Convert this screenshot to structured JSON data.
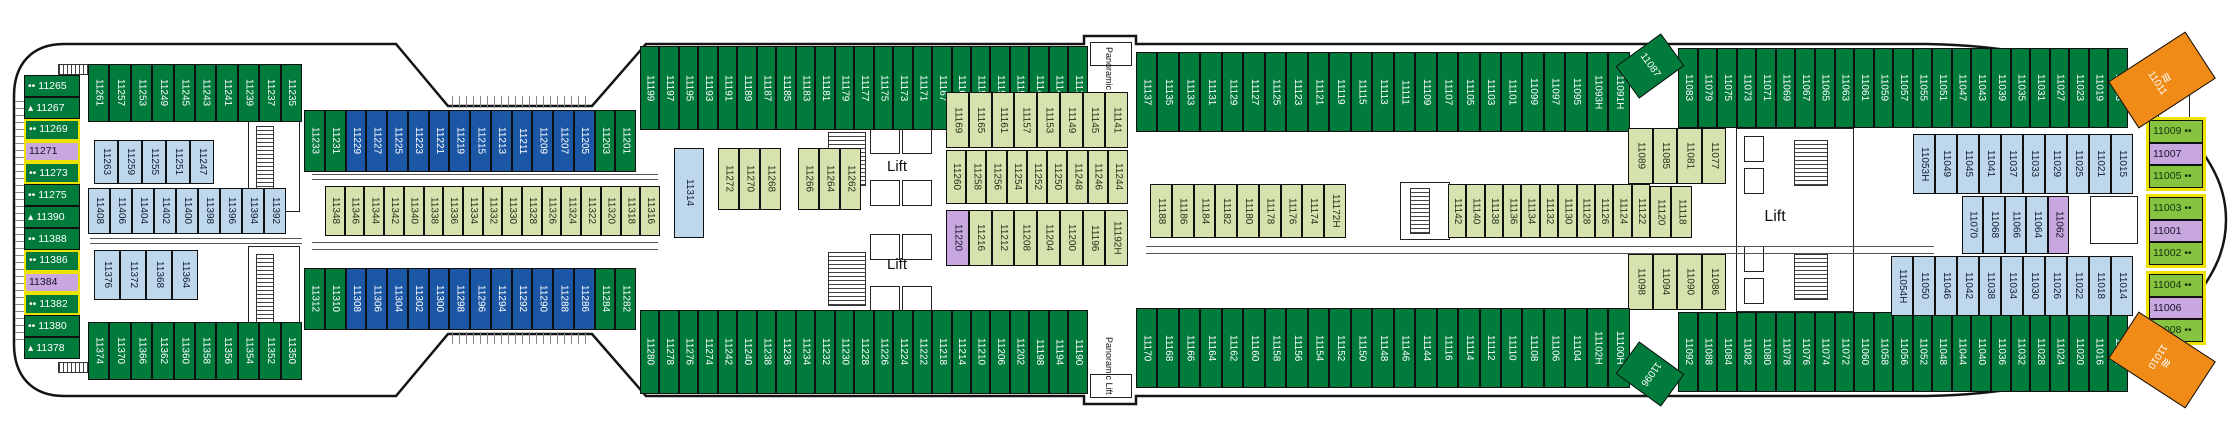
{
  "colors": {
    "green": "#007b3c",
    "blue": "#1b57a5",
    "lightblue": "#bed7eb",
    "olive": "#d6e3ae",
    "purple": "#c7a7de",
    "bowgreen": "#85c341",
    "orange": "#ef8b16"
  },
  "text_colors": {
    "green": "#ffffff",
    "blue": "#ffffff",
    "lightblue": "#0f1f33",
    "olive": "#22331a",
    "purple": "#17122b",
    "bowgreen": "#12300f",
    "orange": "#ffffff"
  },
  "deck": {
    "rows": [
      {
        "id": "stern-column",
        "t": "v",
        "x": 24,
        "y": 75,
        "w": 56,
        "h": 284,
        "c": "green",
        "cells": [
          {
            "n": "11265",
            "m": "••"
          },
          {
            "n": "11267",
            "m": "▴"
          },
          {
            "n": "11269",
            "m": "••",
            "yl": 1
          },
          {
            "n": "11271",
            "c": "purple",
            "yl": 1
          },
          {
            "n": "11273",
            "m": "••",
            "yl": 1
          },
          {
            "n": "11275",
            "m": "••"
          },
          {
            "n": "11390",
            "m": "▴"
          },
          {
            "n": "11388",
            "m": "••"
          },
          {
            "n": "11386",
            "m": "••",
            "yl": 1
          },
          {
            "n": "11384",
            "c": "purple",
            "yl": 1
          },
          {
            "n": "11382",
            "m": "••",
            "yl": 1
          },
          {
            "n": "11380",
            "m": "••"
          },
          {
            "n": "11378",
            "m": "▴"
          }
        ]
      },
      {
        "id": "stern-top-row",
        "t": "h",
        "x": 88,
        "y": 64,
        "w": 214,
        "h": 58,
        "c": "green",
        "cells": [
          "11261",
          "11257",
          "11253",
          "11249",
          "11245",
          "11243",
          "11241",
          "11239",
          "11237",
          "11235"
        ]
      },
      {
        "id": "top-inset-row",
        "t": "h",
        "x": 304,
        "y": 110,
        "w": 332,
        "h": 62,
        "c": "blue",
        "cells": [
          {
            "n": "11233",
            "c": "green"
          },
          {
            "n": "11231",
            "c": "green"
          },
          "11229",
          "11227",
          "11225",
          "11223",
          "11221",
          "11219",
          "11215",
          "11213",
          "11211",
          "11209",
          "11207",
          "11205",
          {
            "n": "11203",
            "c": "green"
          },
          {
            "n": "11201",
            "c": "green"
          }
        ]
      },
      {
        "id": "top-row-a",
        "t": "h",
        "x": 640,
        "y": 46,
        "w": 448,
        "h": 84,
        "c": "green",
        "cells": [
          "11199",
          "11197",
          "11195",
          "11193",
          "11191",
          "11189",
          "11187",
          "11185",
          "11183",
          "11181",
          "11179",
          "11177",
          "11175",
          "11173",
          "11171",
          "11167",
          "11163",
          "11159",
          "11155",
          "11151",
          "11147",
          "11143",
          "11139"
        ]
      },
      {
        "id": "top-row-b",
        "t": "h",
        "x": 1136,
        "y": 52,
        "w": 494,
        "h": 80,
        "c": "green",
        "cells": [
          "11137",
          "11135",
          "11133",
          "11131",
          "11129",
          "11127",
          "11125",
          "11123",
          "11121",
          "11119",
          "11115",
          "11113",
          "11111",
          "11109",
          "11107",
          "11105",
          "11103",
          "11101",
          "11099",
          "11097",
          "11095",
          "11093H",
          "11091H"
        ]
      },
      {
        "id": "top-row-c",
        "t": "h",
        "x": 1678,
        "y": 48,
        "w": 450,
        "h": 80,
        "c": "green",
        "cells": [
          "11083",
          "11079",
          "11075",
          "11073",
          "11071",
          "11069",
          "11067",
          "11065",
          "11063",
          "11061",
          "11059",
          "11057",
          "11055",
          "11051",
          "11047",
          "11043",
          "11039",
          "11035",
          "11031",
          "11027",
          "11023",
          "11019",
          "11013"
        ]
      },
      {
        "id": "upper-blue-row",
        "t": "h",
        "x": 94,
        "y": 140,
        "w": 120,
        "h": 44,
        "c": "lightblue",
        "cells": [
          "11263",
          "11259",
          "11255",
          "11251",
          "11247"
        ]
      },
      {
        "id": "upper-blue-row-2",
        "t": "h",
        "x": 88,
        "y": 188,
        "w": 198,
        "h": 46,
        "c": "lightblue",
        "cells": [
          "11408",
          "11406",
          "11404",
          "11402",
          "11400",
          "11398",
          "11396",
          "11394",
          "11392"
        ]
      },
      {
        "id": "mid-olive-row",
        "t": "h",
        "x": 325,
        "y": 186,
        "w": 335,
        "h": 50,
        "c": "olive",
        "cells": [
          "11348",
          "11346",
          "11344",
          "11342",
          "11340",
          "11338",
          "11336",
          "11334",
          "11332",
          "11330",
          "11328",
          "11326",
          "11324",
          "11322",
          "11320",
          "11318",
          "11316"
        ]
      },
      {
        "id": "cabin-11314-block",
        "t": "h",
        "x": 674,
        "y": 148,
        "w": 30,
        "h": 90,
        "c": "lightblue",
        "cells": [
          "11314"
        ]
      },
      {
        "id": "mid-olive-a",
        "t": "h",
        "x": 718,
        "y": 148,
        "w": 63,
        "h": 62,
        "c": "olive",
        "cells": [
          "11272",
          "11270",
          "11268"
        ]
      },
      {
        "id": "mid-olive-b",
        "t": "h",
        "x": 798,
        "y": 148,
        "w": 63,
        "h": 62,
        "c": "olive",
        "cells": [
          "11266",
          "11264",
          "11262"
        ]
      },
      {
        "id": "right-olive-1",
        "t": "h",
        "x": 946,
        "y": 92,
        "w": 182,
        "h": 56,
        "c": "olive",
        "cells": [
          "11169",
          "11165",
          "11161",
          "11157",
          "11153",
          "11149",
          "11145",
          "11141"
        ]
      },
      {
        "id": "right-olive-2",
        "t": "h",
        "x": 946,
        "y": 150,
        "w": 182,
        "h": 54,
        "c": "olive",
        "cells": [
          "11260",
          "11258",
          "11256",
          "11254",
          "11252",
          "11250",
          "11248",
          "11246",
          "11244"
        ]
      },
      {
        "id": "right-olive-3",
        "t": "h",
        "x": 946,
        "y": 210,
        "w": 182,
        "h": 56,
        "c": "olive",
        "cells": [
          {
            "n": "11220",
            "c": "purple"
          },
          "11216",
          "11212",
          "11208",
          "11204",
          "11200",
          "11196",
          "11192H"
        ]
      },
      {
        "id": "mid-olive-row-2",
        "t": "h",
        "x": 1150,
        "y": 184,
        "w": 196,
        "h": 54,
        "c": "olive",
        "cells": [
          "11188",
          "11186",
          "11184",
          "11182",
          "11180",
          "11178",
          "11176",
          "11174",
          "11172H"
        ]
      },
      {
        "id": "mid-olive-row-3",
        "t": "h",
        "x": 1448,
        "y": 184,
        "w": 202,
        "h": 54,
        "c": "olive",
        "cells": [
          "11142",
          "11140",
          "11138",
          "11136",
          "11134",
          "11132",
          "11130",
          "11128",
          "11126",
          "11124",
          "11122"
        ]
      },
      {
        "id": "mid-olive-row-4",
        "t": "h",
        "x": 1650,
        "y": 186,
        "w": 42,
        "h": 52,
        "c": "olive",
        "cells": [
          "11120",
          "11118"
        ]
      },
      {
        "id": "lift-olive-top",
        "t": "h",
        "x": 1628,
        "y": 128,
        "w": 98,
        "h": 56,
        "c": "olive",
        "cells": [
          "11089",
          "11085",
          "11081",
          "11077"
        ]
      },
      {
        "id": "lift-olive-bottom",
        "t": "h",
        "x": 1628,
        "y": 254,
        "w": 98,
        "h": 56,
        "c": "olive",
        "cells": [
          "11098",
          "11094",
          "11090",
          "11086"
        ]
      },
      {
        "id": "lower-blue-row",
        "t": "h",
        "x": 94,
        "y": 250,
        "w": 104,
        "h": 50,
        "c": "lightblue",
        "cells": [
          "11376",
          "11372",
          "11368",
          "11364"
        ]
      },
      {
        "id": "stern-bottom-row",
        "t": "h",
        "x": 88,
        "y": 322,
        "w": 214,
        "h": 58,
        "c": "green",
        "cells": [
          "11374",
          "11370",
          "11366",
          "11362",
          "11360",
          "11358",
          "11356",
          "11354",
          "11352",
          "11350"
        ]
      },
      {
        "id": "bottom-inset-row",
        "t": "h",
        "x": 304,
        "y": 268,
        "w": 332,
        "h": 62,
        "c": "blue",
        "cells": [
          {
            "n": "11312",
            "c": "green"
          },
          {
            "n": "11310",
            "c": "green"
          },
          "11308",
          "11306",
          "11304",
          "11302",
          "11300",
          "11298",
          "11296",
          "11294",
          "11292",
          "11290",
          "11288",
          "11286",
          {
            "n": "11284",
            "c": "green"
          },
          {
            "n": "11282",
            "c": "green"
          }
        ]
      },
      {
        "id": "bottom-row-a",
        "t": "h",
        "x": 640,
        "y": 310,
        "w": 448,
        "h": 84,
        "c": "green",
        "cells": [
          "11280",
          "11278",
          "11276",
          "11274",
          "11242",
          "11240",
          "11238",
          "11236",
          "11234",
          "11232",
          "11230",
          "11228",
          "11226",
          "11224",
          "11222",
          "11218",
          "11214",
          "11210",
          "11206",
          "11202",
          "11198",
          "11194",
          "11190"
        ]
      },
      {
        "id": "bottom-row-b",
        "t": "h",
        "x": 1136,
        "y": 308,
        "w": 494,
        "h": 80,
        "c": "green",
        "cells": [
          "11170",
          "11168",
          "11166",
          "11164",
          "11162",
          "11160",
          "11158",
          "11156",
          "11154",
          "11152",
          "11150",
          "11148",
          "11146",
          "11144",
          "11116",
          "11114",
          "11112",
          "11110",
          "11108",
          "11106",
          "11104",
          "11102H",
          "11100H"
        ]
      },
      {
        "id": "bottom-row-c",
        "t": "h",
        "x": 1678,
        "y": 312,
        "w": 450,
        "h": 80,
        "c": "green",
        "cells": [
          "11092",
          "11088",
          "11084",
          "11082",
          "11080",
          "11078",
          "11076",
          "11074",
          "11072",
          "11060",
          "11058",
          "11056",
          "11052",
          "11048",
          "11044",
          "11040",
          "11036",
          "11032",
          "11028",
          "11024",
          "11020",
          "11016",
          "11012"
        ]
      },
      {
        "id": "right-blue-upper",
        "t": "h",
        "x": 1913,
        "y": 134,
        "w": 220,
        "h": 60,
        "c": "lightblue",
        "cells": [
          "11053H",
          "11049",
          "11045",
          "11041",
          "11037",
          "11033",
          "11029",
          "11025",
          "11021",
          "11015"
        ]
      },
      {
        "id": "right-blue-center",
        "t": "h",
        "x": 1962,
        "y": 196,
        "w": 107,
        "h": 58,
        "c": "lightblue",
        "cells": [
          "11070",
          "11068",
          "11066",
          "11064",
          {
            "n": "11062",
            "c": "purple"
          }
        ]
      },
      {
        "id": "right-blue-lower",
        "t": "h",
        "x": 1891,
        "y": 256,
        "w": 242,
        "h": 60,
        "c": "lightblue",
        "cells": [
          "11054H",
          "11050",
          "11046",
          "11042",
          "11038",
          "11034",
          "11030",
          "11026",
          "11022",
          "11018",
          "11014"
        ]
      },
      {
        "id": "bow-group-1",
        "t": "v",
        "x": 2146,
        "y": 117,
        "w": 60,
        "h": 74,
        "c": "bowgreen",
        "b": 1,
        "cells": [
          {
            "n": "11009",
            "ma": "••"
          },
          {
            "n": "11007",
            "c": "purple"
          },
          {
            "n": "11005",
            "ma": "••"
          }
        ]
      },
      {
        "id": "bow-group-2",
        "t": "v",
        "x": 2146,
        "y": 194,
        "w": 60,
        "h": 74,
        "c": "bowgreen",
        "b": 1,
        "cells": [
          {
            "n": "11003",
            "ma": "••"
          },
          {
            "n": "11001",
            "c": "purple"
          },
          {
            "n": "11002",
            "ma": "••"
          }
        ]
      },
      {
        "id": "bow-group-3",
        "t": "v",
        "x": 2146,
        "y": 271,
        "w": 60,
        "h": 74,
        "c": "bowgreen",
        "b": 1,
        "cells": [
          {
            "n": "11004",
            "ma": "••"
          },
          {
            "n": "11006",
            "c": "purple"
          },
          {
            "n": "11008",
            "ma": "••"
          }
        ]
      }
    ],
    "special": [
      {
        "n": "11087",
        "x": 1622,
        "y": 46,
        "w": 56,
        "h": 40,
        "rot": -36,
        "c": "green"
      },
      {
        "n": "11096",
        "x": 1622,
        "y": 354,
        "w": 56,
        "h": 40,
        "rot": 36,
        "c": "green"
      },
      {
        "n": "11011",
        "x": 2116,
        "y": 52,
        "w": 92,
        "h": 56,
        "rot": -33,
        "c": "orange",
        "icon": "≋"
      },
      {
        "n": "11010",
        "x": 2116,
        "y": 332,
        "w": 92,
        "h": 56,
        "rot": 33,
        "c": "orange",
        "icon": "≋"
      }
    ],
    "labels": [
      {
        "t": "Lift",
        "x": 874,
        "y": 156,
        "w": 46,
        "h": 20,
        "fs": 15
      },
      {
        "t": "Lift",
        "x": 874,
        "y": 254,
        "w": 46,
        "h": 20,
        "fs": 15
      },
      {
        "t": "Lift",
        "x": 1748,
        "y": 206,
        "w": 54,
        "h": 22,
        "fs": 16
      },
      {
        "t": "Panoramic Lift",
        "x": 1087,
        "y": 46,
        "w": 44,
        "h": 60,
        "fs": 9,
        "vert": 1
      },
      {
        "t": "Panoramic Lift",
        "x": 1087,
        "y": 336,
        "w": 44,
        "h": 60,
        "fs": 9,
        "vert": 1
      }
    ]
  }
}
